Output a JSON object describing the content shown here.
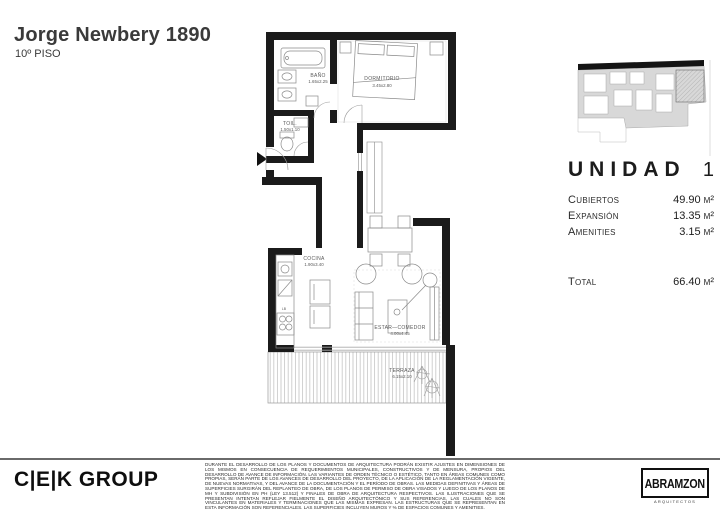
{
  "header": {
    "title": "Jorge Newbery 1890",
    "subtitle": "10º PISO"
  },
  "plan": {
    "rooms": [
      {
        "id": "bano",
        "name": "BAÑO",
        "dims": "1.65x2.25"
      },
      {
        "id": "toilette",
        "name": "TOIL.",
        "dims": "1.50x1.10"
      },
      {
        "id": "dormitorio",
        "name": "DORMITORIO",
        "dims": "3.45x2.80"
      },
      {
        "id": "cocina",
        "name": "COCINA",
        "dims": "1.90x3.40"
      },
      {
        "id": "estar",
        "name": "ESTAR—COMEDOR",
        "dims": "4.00x4.45"
      },
      {
        "id": "terraza",
        "name": "TERRAZA",
        "dims": "6.15x2.10"
      }
    ],
    "kitchen_note": "LB"
  },
  "unit_panel": {
    "unit_label": "UNIDAD",
    "unit_number": "1",
    "rows": [
      {
        "label": "Cubiertos",
        "value": "49.90 m²"
      },
      {
        "label": "Expansión",
        "value": "13.35 m²"
      },
      {
        "label": "Amenities",
        "value": "3.15 m²"
      }
    ],
    "total": {
      "label": "Total",
      "value": "66.40 m²"
    }
  },
  "footer": {
    "cek_logo": "C|E|K GROUP",
    "disclaimer": "DURANTE EL DESARROLLO DE LOS PLANOS Y DOCUMENTOS DE ARQUITECTURA PODRÁN EXISTIR AJUSTES EN DIMENSIONES DE LOS MISMOS EN CONSECUENCIA DE REQUERIMIENTOS MUNICIPALES, CONSTRUCTIVOS Y DE MENSURA, PROPIOS DEL DESARROLLO DE AVANCE DE INFORMACIÓN. LAS VARIANTES DE ORDEN TÉCNICO O ESTÉTICO, TANTO EN ÁREAS COMUNES COMO PROPIAS, SERÁN PARTE DE LOS AVANCES DE DESARROLLO DEL PROYECTO, DE LA APLICACIÓN DE LA REGLAMENTACIÓN VIGENTE, DE NUEVAS NORMATIVAS, Y DEL AVANCE DE LA DOCUMENTACIÓN Y EL PERÍODO DE OBRAS. LAS MEDIDAS DEFINITIVAS Y ÁREAS DE SUPERFICIES SURGIRÁN DEL REPLANTEO DE OBRA, DE LOS PLANOS DE PERMISO DE OBRA VISADOS Y LUEGO DE LOS PLANOS DE MH Y SUBDIVISIÓN EN PH (LEY 13.512) Y FINALES DE OBRA DE ARQUITECTURA RESPECTIVOS. LAS ILUSTRACIONES QUE SE PRESENTAN INTENTAN REFLEJAR FIELMENTE EL DISEÑO ARQUITECTÓNICO Y SUS REFERENCIAS, LAS CUALES NO SON VINCULANTES EN MATERIALES Y TERMINACIONES QUE LAS MISMAS EXPRESAN. LAS ESTRUCTURAS QUE SE REPRESENTAN EN ESTA INFORMACIÓN SON REFERENCIALES. LAS SUPERFICIES INCLUYEN MUROS Y % DE ESPACIOS COMUNES Y AMENITIES.",
    "abramzon_name": "ABRAMZON",
    "abramzon_tagline": "ARQUITECTOS"
  },
  "colors": {
    "wall": "#1b1b1b",
    "furniture": "#8a8a8a",
    "keyplan_gray": "#d8d8d8",
    "hatch": "#a8a8a8"
  }
}
